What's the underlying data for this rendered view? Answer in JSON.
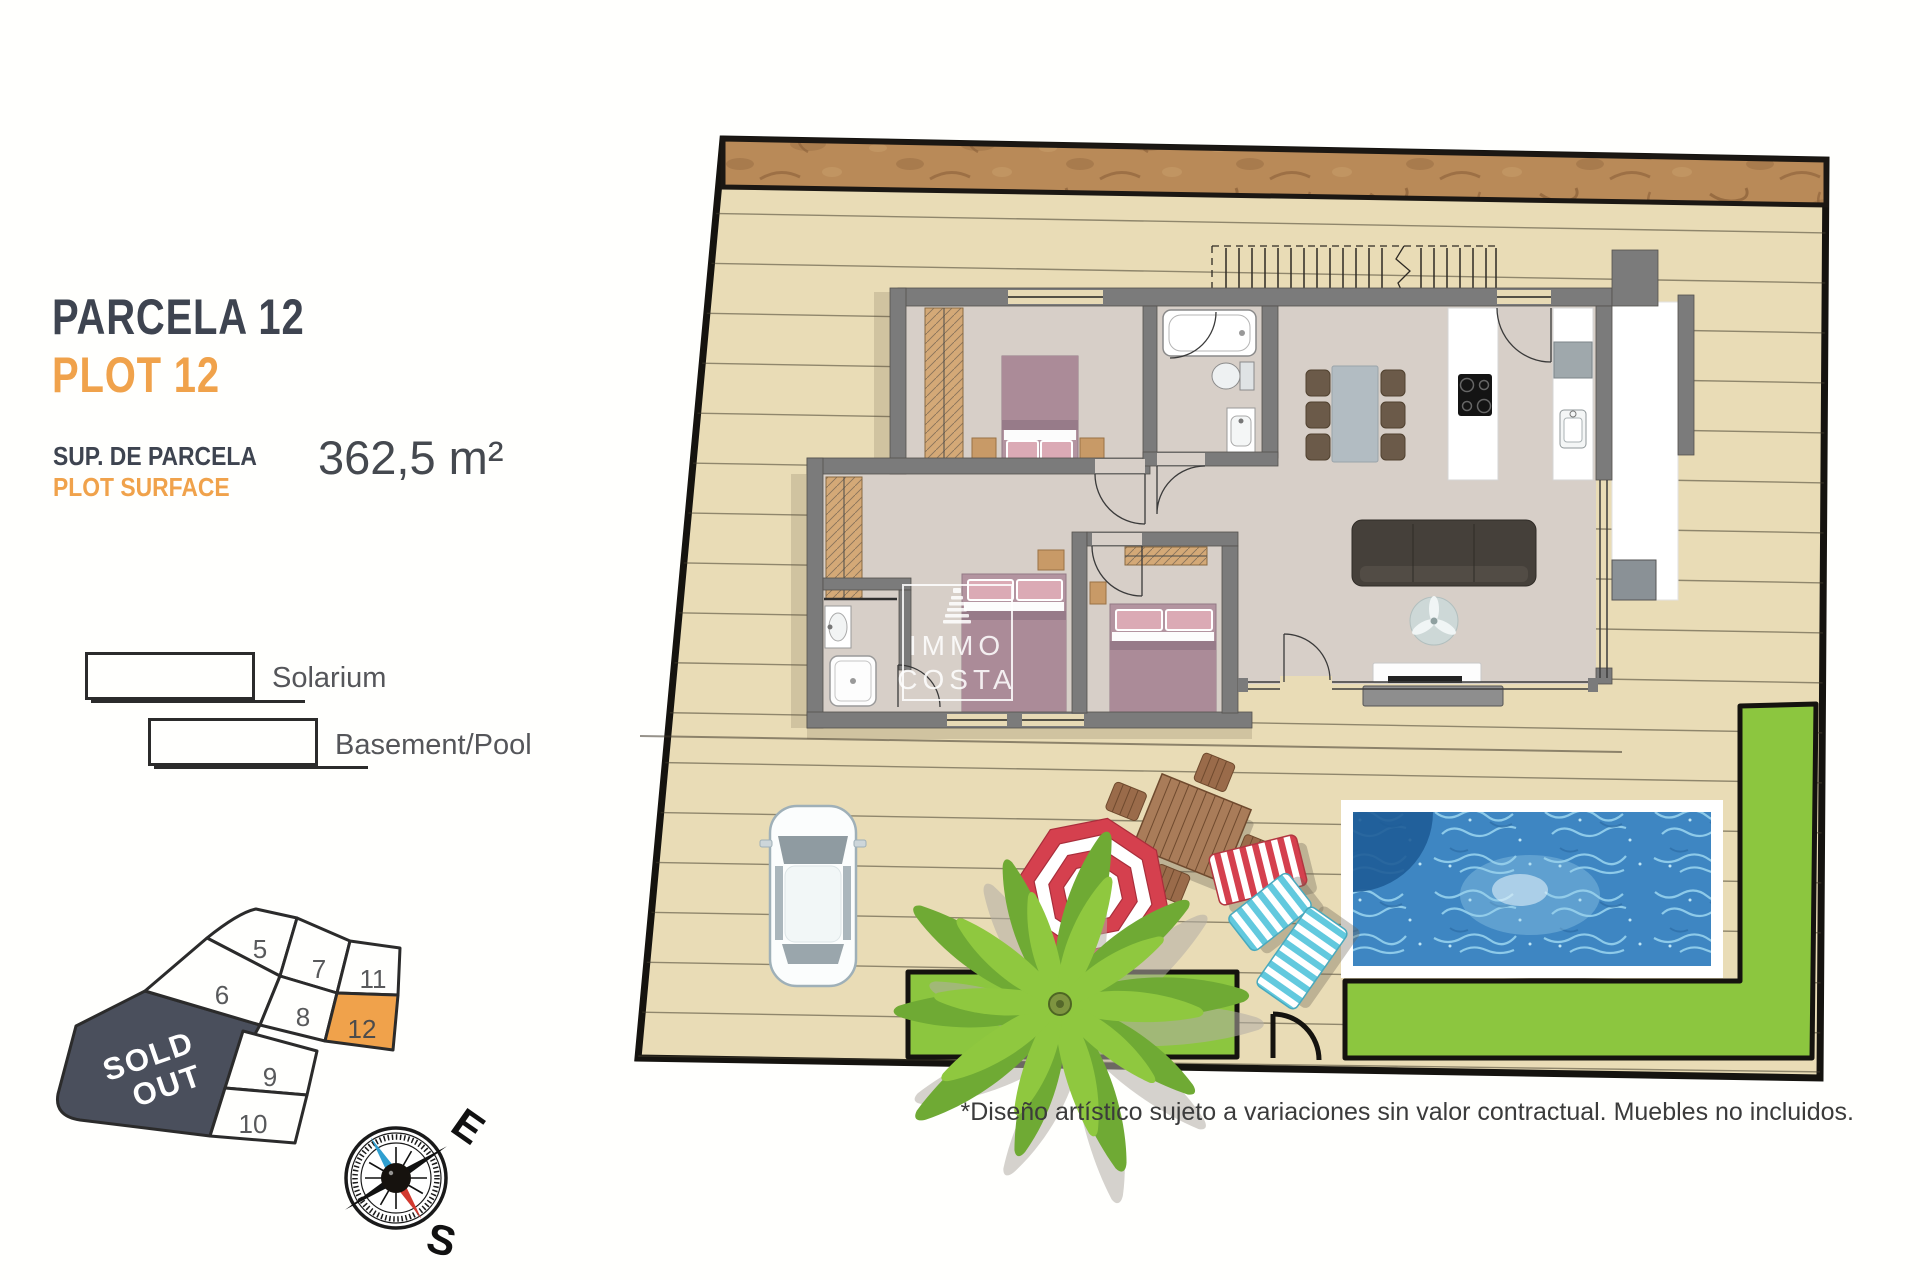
{
  "panel": {
    "title_primary": "PARCELA 12",
    "title_secondary": "PLOT 12",
    "area_label_primary": "SUP. DE PARCELA",
    "area_label_secondary": "PLOT SURFACE",
    "area_value": "362,5 m²",
    "legend": [
      {
        "label": "Solarium"
      },
      {
        "label": "Basement/Pool"
      }
    ]
  },
  "site_map": {
    "plots": [
      "5",
      "6",
      "7",
      "8",
      "9",
      "10",
      "11",
      "12"
    ],
    "highlighted_plot": "12",
    "sold_out": {
      "line1": "SOLD",
      "line2": "OUT"
    },
    "highlight_color": "#F0A24B",
    "sold_out_color": "#4A4F5C"
  },
  "compass": {
    "east": "E",
    "south": "S"
  },
  "watermark": {
    "line1": "IMMO",
    "line2": "COSTA"
  },
  "disclaimer": "*Diseño artístico sujeto a variaciones sin valor contractual. Muebles no incluidos.",
  "colors": {
    "title_dark": "#3E4450",
    "accent_orange": "#F0A24B",
    "deck": "#E9DCB6",
    "wall_gray": "#7B7B7B",
    "grass": "#8CC63F",
    "pool_water": "#3E86C2",
    "umbrella_red": "#D5404E"
  }
}
